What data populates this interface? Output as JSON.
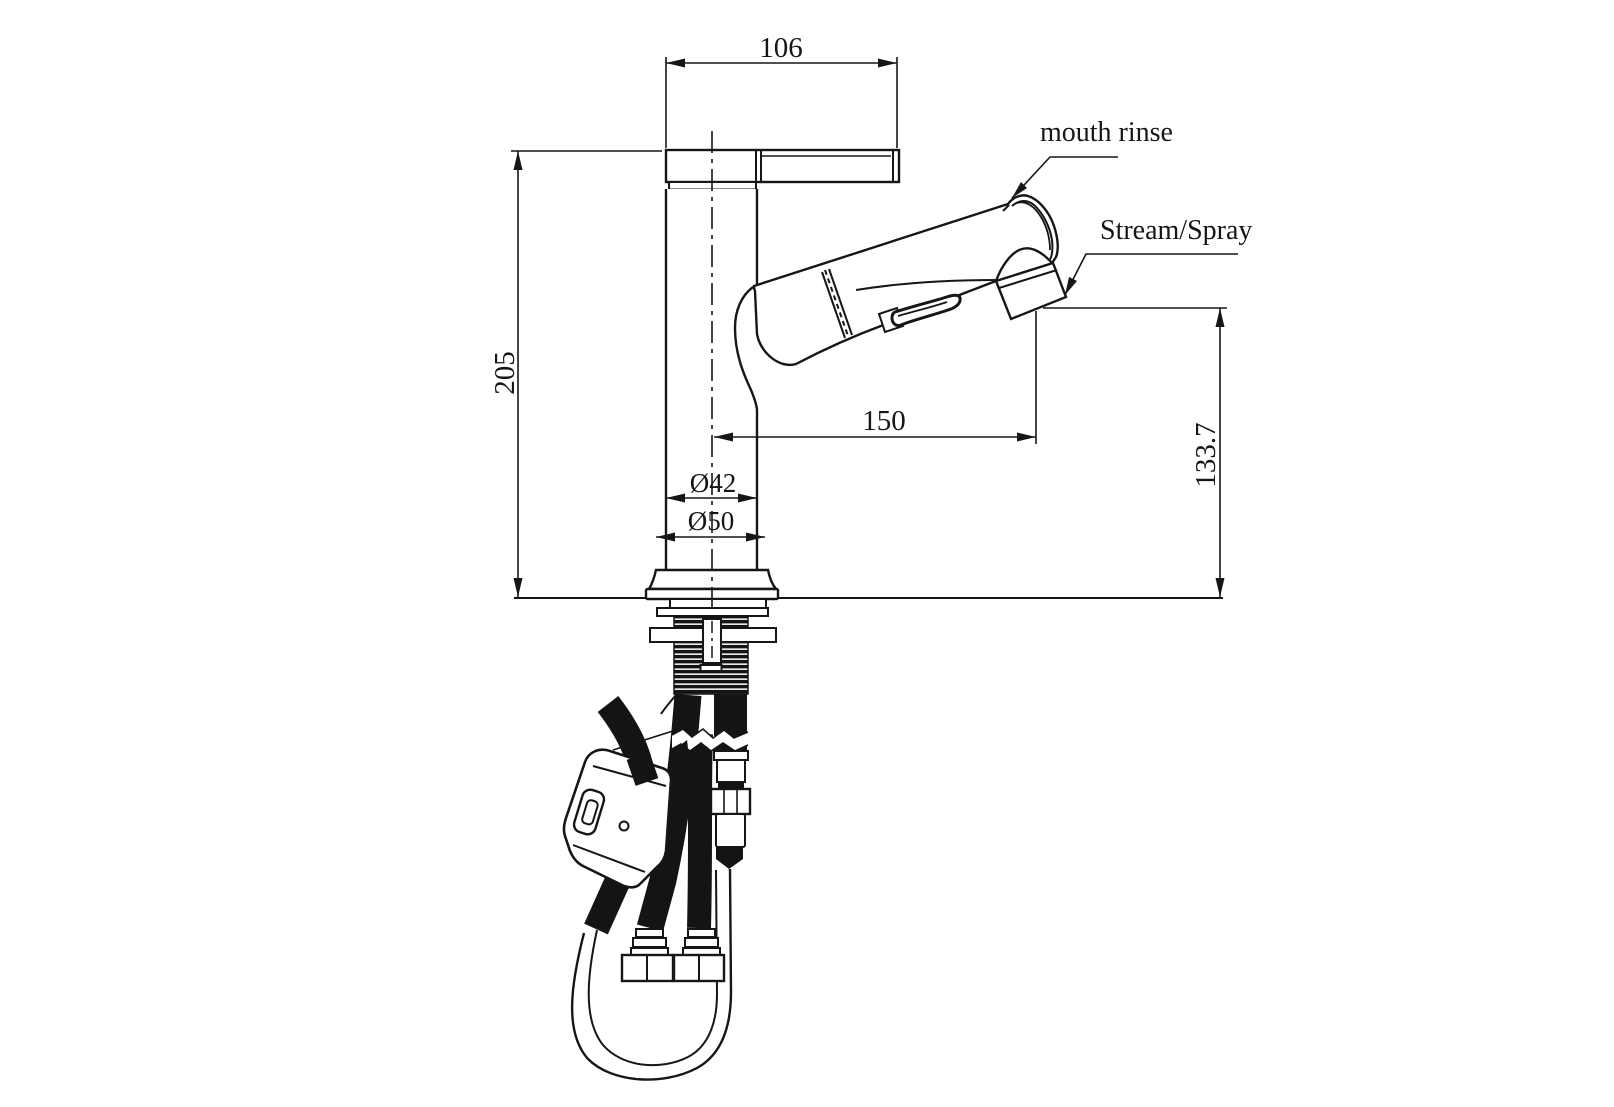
{
  "drawing": {
    "colors": {
      "line_color": "#161616",
      "background": "#ffffff"
    },
    "dimensions": {
      "top_width": "106",
      "overall_height": "205",
      "spout_reach": "150",
      "outlet_height": "133.7",
      "body_diameter": "Ø42",
      "base_diameter": "Ø50"
    },
    "labels": {
      "mouth_rinse": "mouth rinse",
      "stream_spray": "Stream/Spray"
    }
  }
}
